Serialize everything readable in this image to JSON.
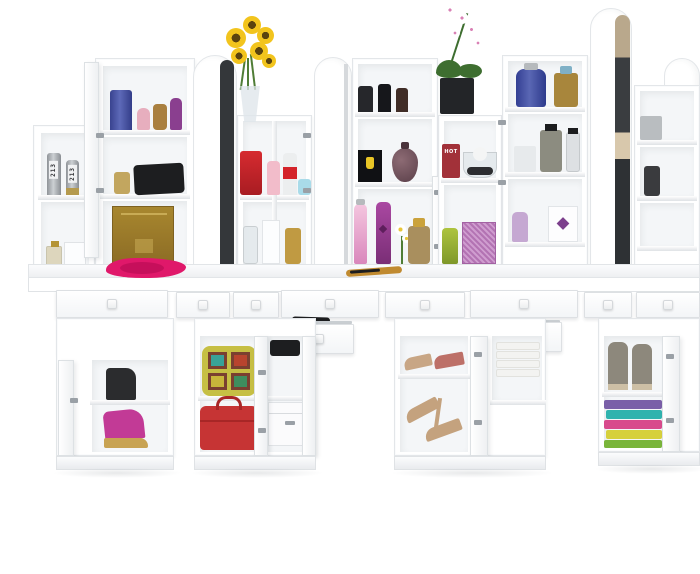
{
  "meta": {
    "description": "3D product render of a white dressing-table vanity wall unit: four make-up stations with arch-top mirrors, open shelf towers of perfumes and cosmetics, a sunflower bouquet and an orchid on top, long table with pulled-out drawers, and pedestal cabinets holding shoes, bags and folded towels on a white floor",
    "background": "#ffffff"
  },
  "furniture": {
    "base_color": "#ffffff",
    "edge_color": "#e3e6e9",
    "cavity_color": "#f4f6f8",
    "stations": "4",
    "arch_mirrors": "4",
    "open_drawers": "7",
    "pedestal_cabinets": "4"
  },
  "labels": {
    "canister_left": "213",
    "canister_right": "213",
    "hot_box": "HOT"
  },
  "colors": {
    "silver": "linear-gradient(90deg,#8f9398,#ccd0d3 45%,#8a8e93)",
    "canister_gold_base": "#b59a4e",
    "small_perfume": "#ddd6bd",
    "small_perfume_cap": "#b49435",
    "card": "#fcfdfe",
    "navy_bottle": "linear-gradient(90deg,#39438f,#5d69b8 45%,#333d89)",
    "pink_mini": "#e7aebe",
    "amber_mini": "#a97f3f",
    "purple_mini": "#8a3f8f",
    "gold_jar": "#c2a65f",
    "black_clutch": "#1d1e20",
    "gold_box": "linear-gradient(#a8872f,#8d6d25)",
    "gold_box_band": "#c8ab55",
    "pink_fabric": "#e0186a",
    "pink_fabric_dark": "#bf0e57",
    "sunflower": "radial-gradient(circle,#5a430f 0 30%,#f2c41d 31%)",
    "leaf": "#4f7d36",
    "vase": "rgba(223,230,234,0.78)",
    "red_canister": "linear-gradient(#d62b30,#a81c22)",
    "pink_tube": "#f2bcca",
    "deo_body": "#eceeef",
    "deo_band": "#d4232a",
    "blue_jar": "#a9dbe9",
    "glass": "rgba(226,232,235,0.85)",
    "white_box": "#fcfdfe",
    "gold_perfume": "#c09a42",
    "blk_cyl_a": "#26272b",
    "blk_cyl_b": "#16171b",
    "blk_cyl_c": "#402d27",
    "ferrari": "#101114",
    "crest": "#e9c526",
    "teardrop": "radial-gradient(circle at 35% 35%,#8d6b74,#5a3f49)",
    "teardrop_cap": "#4a333b",
    "pink_spray": "linear-gradient(#f4c6df,#d987bc)",
    "purple_spray": "linear-gradient(#aa48a2,#7a2e76)",
    "heart": "#5e1f5c",
    "daisy": "radial-gradient(#e8c63a 0 26%,#ffffff 28%)",
    "amber_perfume": "#a98f5e",
    "gold_cap": "#caa23c",
    "brush": "#c08a30",
    "orchid_pot": "#232528",
    "orchid_leaf": "#3e6e30",
    "orchid_flower": "radial-gradient(#d981b5 0 18%,#ffffff 20%)",
    "hot_box": "#a23139",
    "sphere": "#f4f5f5",
    "stones": "#2c2d30",
    "green_tube": "linear-gradient(#aec43e,#7f982a)",
    "pattern_box": "repeating-linear-gradient(45deg,#b373b3 0 2px,#cf9ccf 2px 4px)",
    "blue_flask": "linear-gradient(90deg,#333f93,#5a67b4 45%,#2d3a8c)",
    "silver_cap": "#b6babd",
    "gold_blue": "#a8863c",
    "blue_cap": "#7fb0c6",
    "frosted": "#e7eaec",
    "grey_bottle": "#8c8c80",
    "dark_cap": "#1c1d1f",
    "clear_cyl": "rgba(218,222,224,0.9)",
    "gem_box": "#fdfdfe",
    "gem": "#7c3f8c",
    "lavender": "#c5a8d2",
    "grey_box_sm": "#b9bdc0",
    "dark_bottle_sm": "#3a3b3e",
    "black_boot": "#2b2c2e",
    "wedge_pink": "#c23a96",
    "wedge_gold": "#c8a353",
    "backpack": "#c6bf44",
    "pack_tile_frame": "#7a4030",
    "tile_a": "#39a297",
    "tile_b": "#b8442e",
    "tile_c": "#c8b63a",
    "tile_d": "#3e8e5e",
    "pack_pocket": "#3aa89f",
    "handbag": "#c63434",
    "handbag_dark": "#a82626",
    "storage": "#fbfbfc",
    "metal": "#9aa0a6",
    "peep_beige": "#c8a685",
    "peep_rose": "#bd7068",
    "heel_beige": "#c4a27e",
    "white_towel": "#f3f3f1",
    "boots_grey": "#8d887c",
    "boots_sole": "#cdbfa5",
    "towel1": "#7a5fa8",
    "towel2": "#2fb3ae",
    "towel3": "#d84a8c",
    "towel4": "#d6d03c",
    "towel5": "#7ab53a",
    "mirror_face": "#34373a",
    "mirror_reflection": "linear-gradient(180deg,#b9a88c 0 16%,#3a3d40 16% 44%,#d8c8ac 44% 54%,#2e3134 54%)"
  }
}
